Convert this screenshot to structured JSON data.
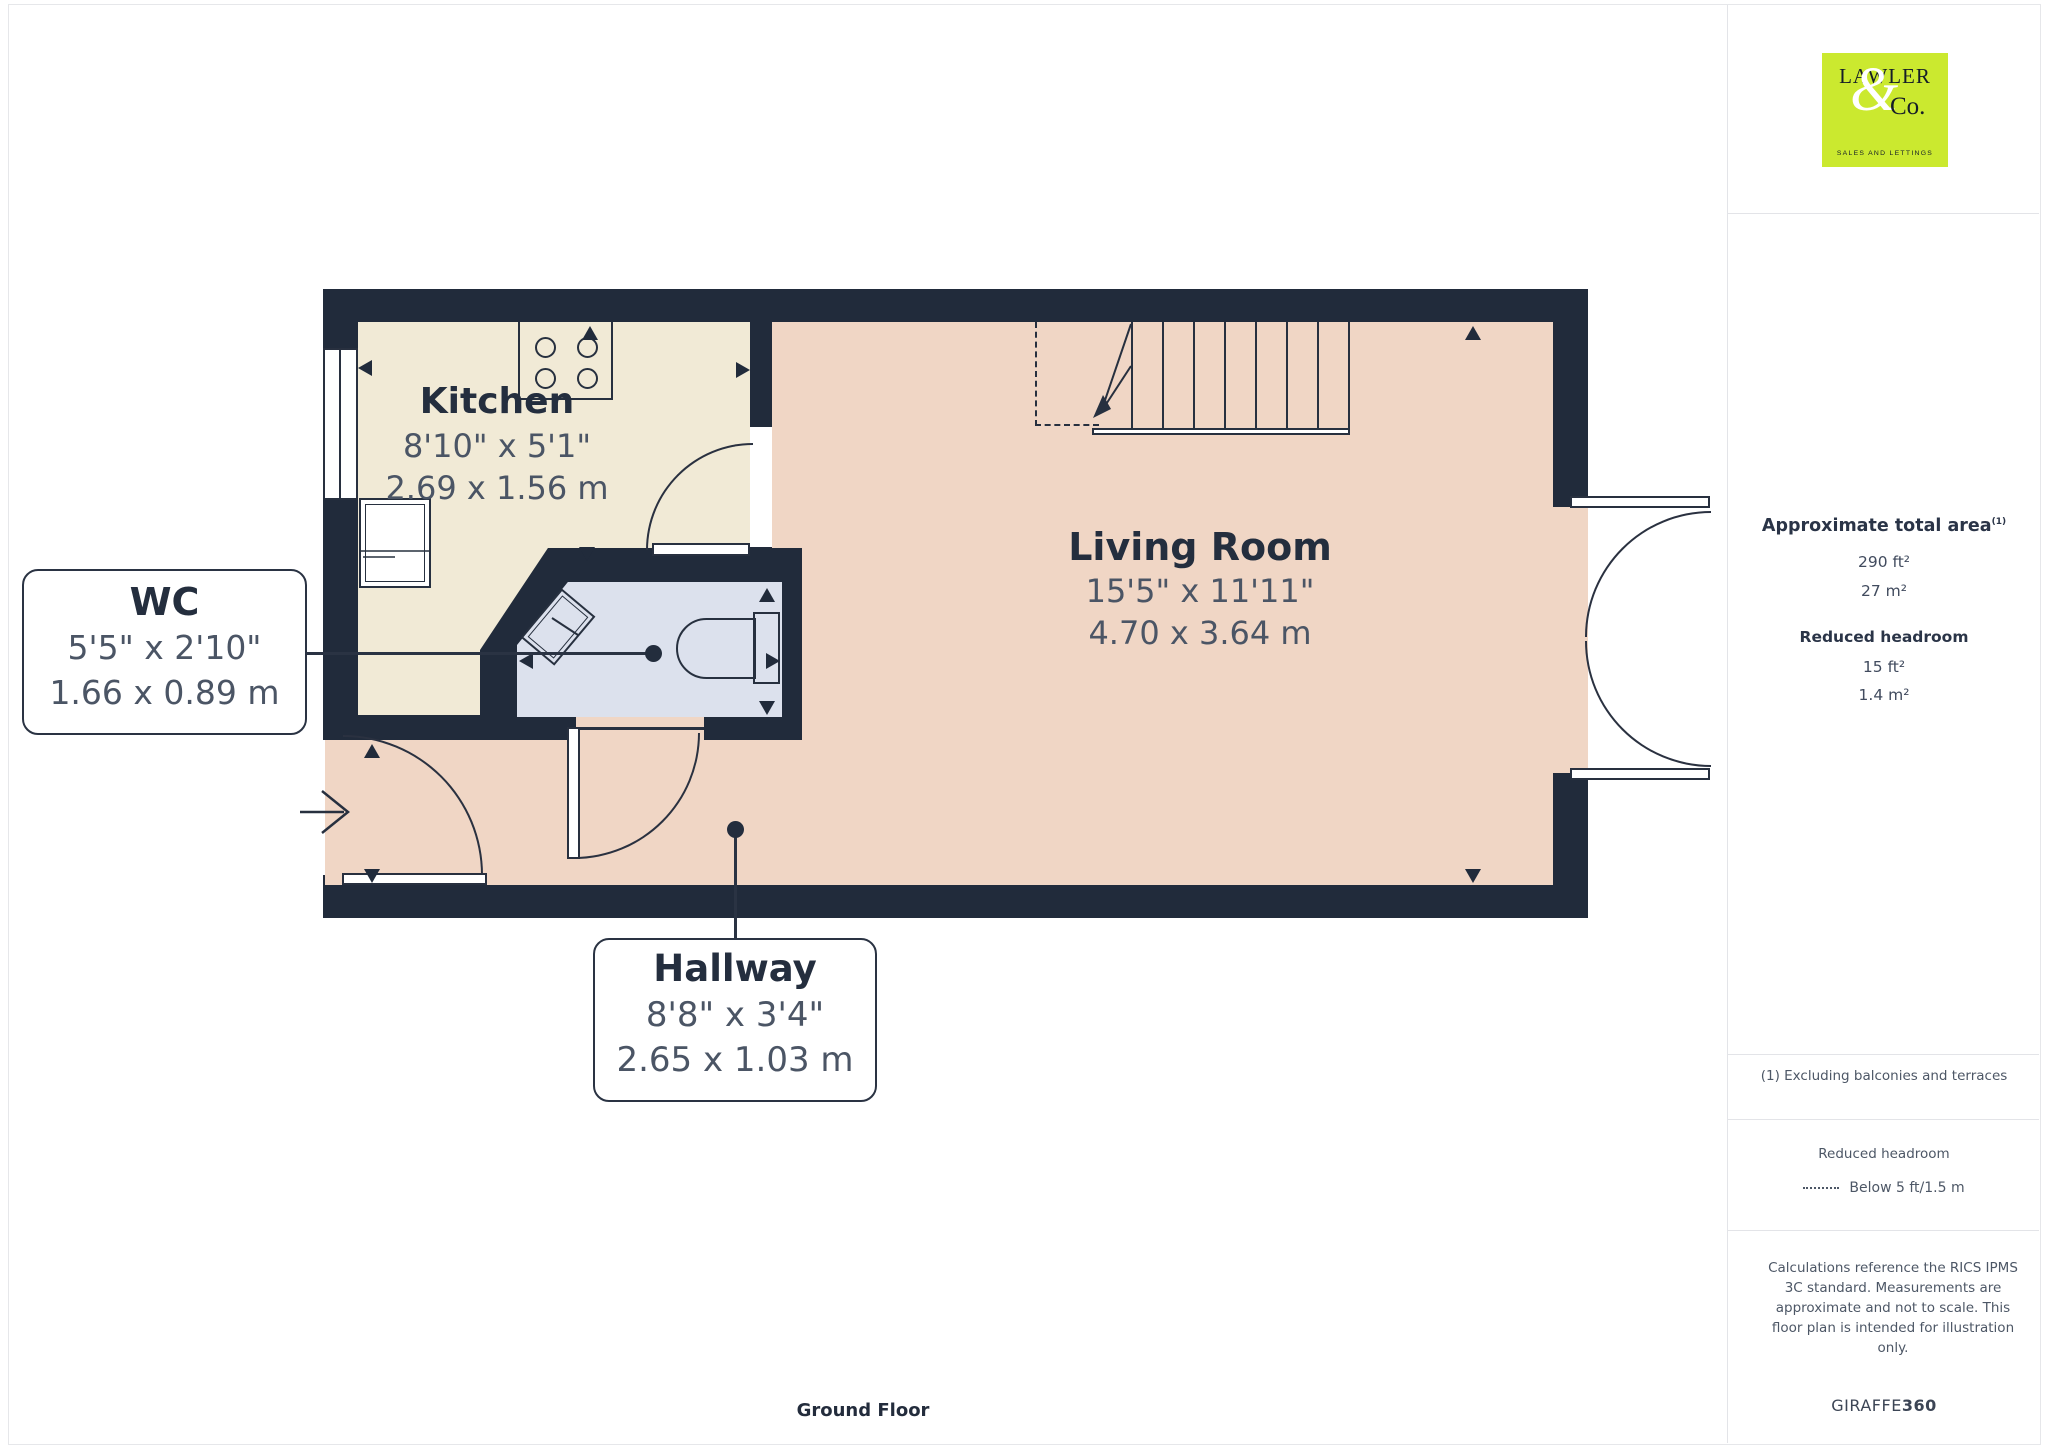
{
  "page": {
    "floor_label": "Ground Floor"
  },
  "logo": {
    "name_top": "LAWLER",
    "ampersand": "&",
    "name_bottom": "Co.",
    "tagline": "SALES AND LETTINGS"
  },
  "sidebar": {
    "area_title": "Approximate total area",
    "area_footnote_marker": "(1)",
    "area_imperial": "290 ft²",
    "area_metric": "27 m²",
    "headroom_title": "Reduced headroom",
    "headroom_imperial": "15 ft²",
    "headroom_metric": "1.4 m²",
    "footnote": "(1) Excluding balconies and terraces",
    "legend_title": "Reduced headroom",
    "legend_item": "Below 5 ft/1.5 m",
    "disclaimer": "Calculations reference the RICS IPMS 3C standard. Measurements are approximate and not to scale. This floor plan is intended for illustration only.",
    "brand_regular": "GIRAFFE",
    "brand_bold": "360"
  },
  "rooms": {
    "kitchen": {
      "name": "Kitchen",
      "imperial": "8'10\" x 5'1\"",
      "metric": "2.69 x 1.56 m"
    },
    "living_room": {
      "name": "Living Room",
      "imperial": "15'5\" x 11'11\"",
      "metric": "4.70 x 3.64 m"
    },
    "wc": {
      "name": "WC",
      "imperial": "5'5\" x 2'10\"",
      "metric": "1.66 x 0.89 m"
    },
    "hallway": {
      "name": "Hallway",
      "imperial": "8'8\" x 3'4\"",
      "metric": "2.65 x 1.03 m"
    }
  },
  "colors": {
    "wall": "#212b3b",
    "kitchen_floor": "#f1ead6",
    "living_floor": "#f0d6c5",
    "wc_floor": "#dce1ed",
    "logo_bg": "#cbe92f"
  }
}
